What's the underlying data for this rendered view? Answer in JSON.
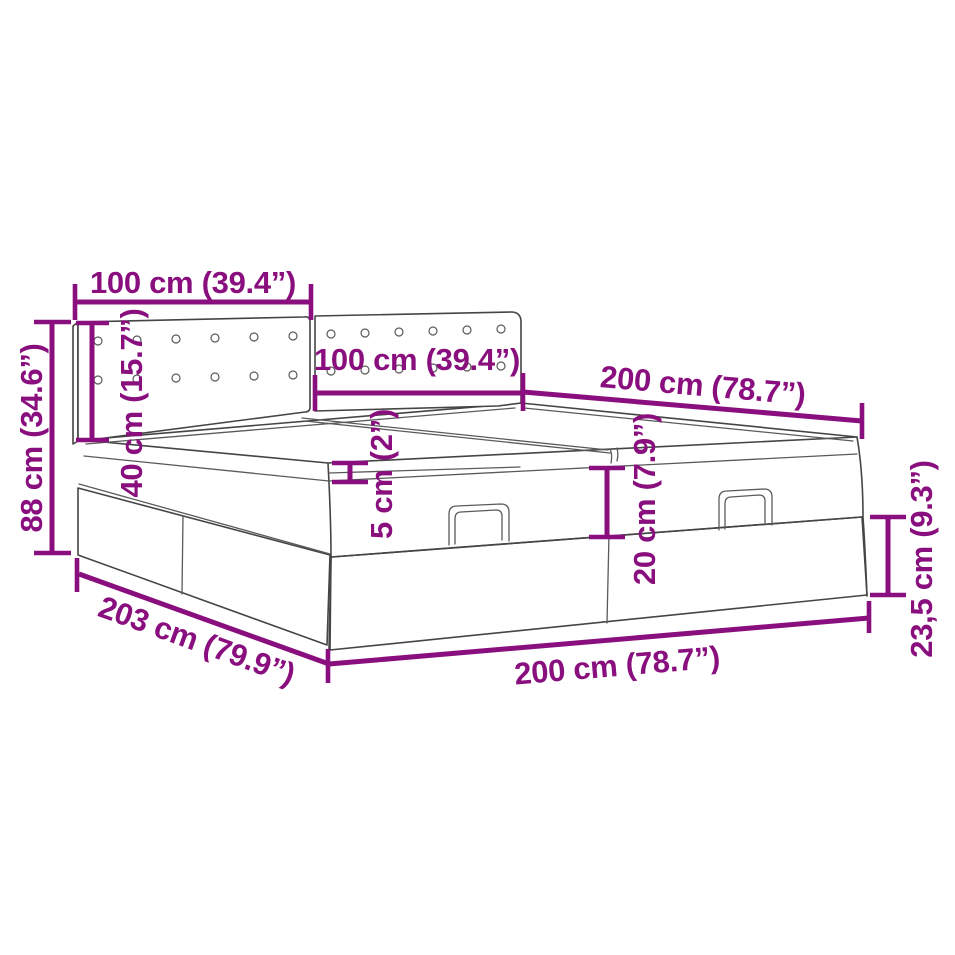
{
  "diagram": {
    "title": "ottoman-storage-bed-dimension-diagram",
    "background": "#ffffff",
    "colors": {
      "dimension_annotation": "#8a0f7e",
      "drawing_outline": "#454545"
    },
    "dimensions": [
      {
        "id": "headboard-panel-left-width",
        "label": "100 cm (39.4”)"
      },
      {
        "id": "headboard-panel-right-width",
        "label": "100 cm (39.4”)"
      },
      {
        "id": "bed-length-top",
        "label": "200 cm (78.7”)"
      },
      {
        "id": "total-height",
        "label": "88 cm (34.6”)"
      },
      {
        "id": "headboard-above-mattress",
        "label": "40 cm (15.7”)"
      },
      {
        "id": "topper-thickness",
        "label": "5 cm (2”)"
      },
      {
        "id": "mattress-thickness",
        "label": "20 cm (7.9”)"
      },
      {
        "id": "frame-height",
        "label": "23,5 cm (9.3”)"
      },
      {
        "id": "frame-length-bottom",
        "label": "203 cm (79.9”)"
      },
      {
        "id": "bed-width-bottom",
        "label": "200 cm (78.7”)"
      }
    ]
  }
}
